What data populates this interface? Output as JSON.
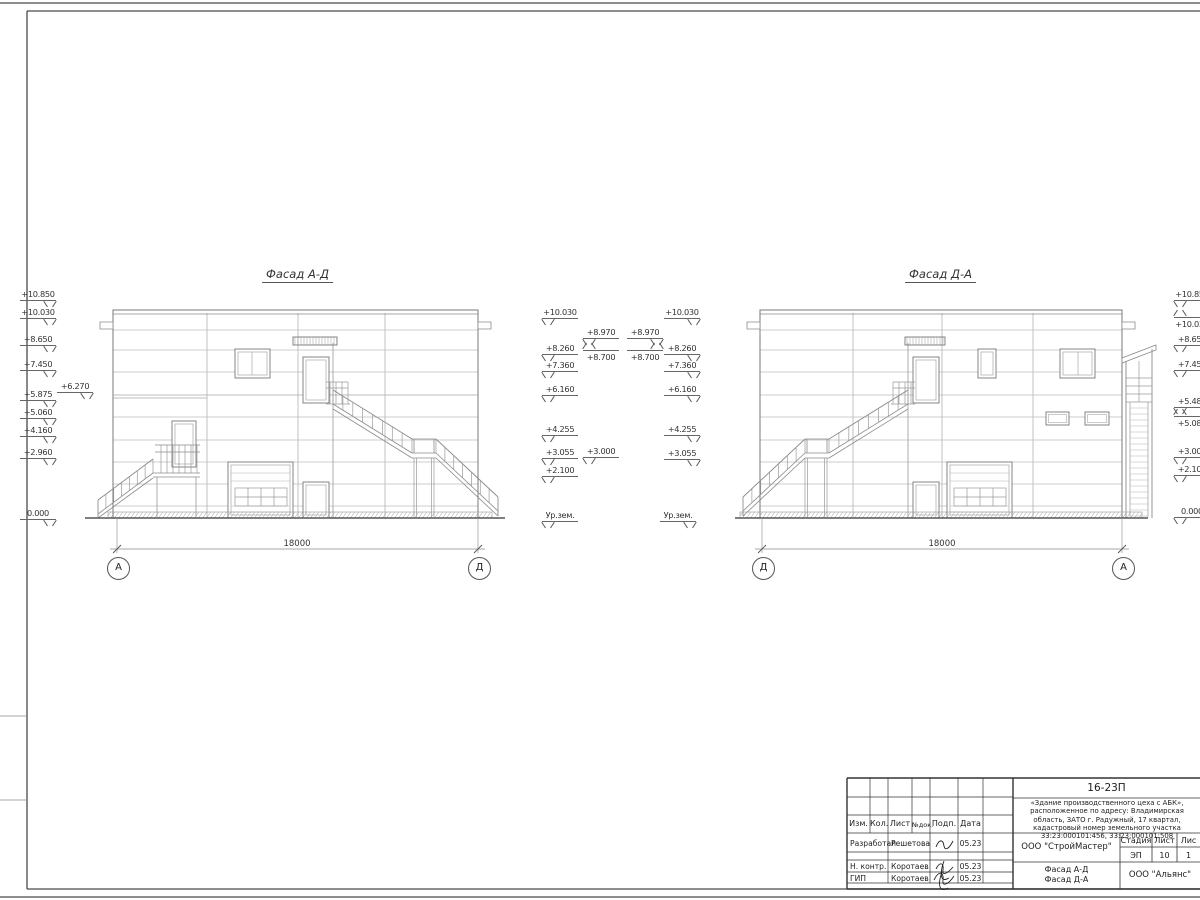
{
  "sheet": {
    "code": "16-23П",
    "project_description": "«Здание производственного цеха с АБК», расположенное по адресу: Владимирская область, ЗАТО г. Радужный, 17 квартал, кадастровый номер земельного участка 33:23:000101:456, 33:23:000101:508",
    "design_org": "ООО \"СтройМастер\"",
    "contractor_org": "ООО \"Альянс\"",
    "sheet_title_line1": "Фасад А-Д",
    "sheet_title_line2": "Фасад Д-А",
    "stage_label": "Стадия",
    "stage_value": "ЭП",
    "sheet_label": "Лист",
    "sheet_value": "10",
    "sheets_label": "Лис",
    "sheets_value": "1",
    "header_cols": [
      "Изм.",
      "Кол.",
      "Лист",
      "№док.",
      "Подп.",
      "Дата"
    ],
    "rows": [
      {
        "role": "Разработал",
        "name": "Решетова",
        "date": "05.23"
      },
      {
        "role": "Н. контр.",
        "name": "Коротаев",
        "date": "05.23"
      },
      {
        "role": "ГИП",
        "name": "Коротаев",
        "date": "05.23"
      }
    ]
  },
  "facades": {
    "left": {
      "title": "Фасад А-Д",
      "dimension": "18000",
      "axis_left": "А",
      "axis_right": "Д"
    },
    "right": {
      "title": "Фасад Д-А",
      "dimension": "18000",
      "axis_left": "Д",
      "axis_right": "А"
    }
  },
  "elevation_marks": [
    {
      "text": "+10.850",
      "x": 20,
      "y": 301,
      "v": "br"
    },
    {
      "text": "+10.030",
      "x": 20,
      "y": 319,
      "v": "br"
    },
    {
      "text": "+8.650",
      "x": 20,
      "y": 346,
      "v": "br"
    },
    {
      "text": "+7.450",
      "x": 20,
      "y": 371,
      "v": "br"
    },
    {
      "text": "+6.270",
      "x": 57,
      "y": 393,
      "v": "br"
    },
    {
      "text": "+5.875",
      "x": 20,
      "y": 401,
      "v": "br"
    },
    {
      "text": "+5.060",
      "x": 20,
      "y": 419,
      "v": "br"
    },
    {
      "text": "+4.160",
      "x": 20,
      "y": 437,
      "v": "br"
    },
    {
      "text": "+2.960",
      "x": 20,
      "y": 459,
      "v": "br"
    },
    {
      "text": "0.000",
      "x": 20,
      "y": 520,
      "v": "br"
    },
    {
      "text": "+10.030",
      "x": 542,
      "y": 319,
      "v": "bl"
    },
    {
      "text": "+8.260",
      "x": 542,
      "y": 355,
      "v": "bl"
    },
    {
      "text": "+7.360",
      "x": 542,
      "y": 372,
      "v": "bl"
    },
    {
      "text": "+6.160",
      "x": 542,
      "y": 396,
      "v": "bl"
    },
    {
      "text": "+4.255",
      "x": 542,
      "y": 436,
      "v": "bl"
    },
    {
      "text": "+3.055",
      "x": 542,
      "y": 459,
      "v": "bl"
    },
    {
      "text": "+2.100",
      "x": 542,
      "y": 477,
      "v": "bl"
    },
    {
      "text": "Ур.зем.",
      "x": 542,
      "y": 522,
      "v": "bl"
    },
    {
      "text": "+8.970",
      "x": 583,
      "y": 339,
      "v": "bl"
    },
    {
      "text": "+8.700",
      "x": 583,
      "y": 350,
      "v": "tl"
    },
    {
      "text": "+8.970",
      "x": 627,
      "y": 339,
      "v": "br"
    },
    {
      "text": "+8.700",
      "x": 627,
      "y": 350,
      "v": "tr"
    },
    {
      "text": "+3.000",
      "x": 583,
      "y": 458,
      "v": "bl"
    },
    {
      "text": "+10.030",
      "x": 664,
      "y": 319,
      "v": "br"
    },
    {
      "text": "+8.260",
      "x": 664,
      "y": 355,
      "v": "br"
    },
    {
      "text": "+7.360",
      "x": 664,
      "y": 372,
      "v": "br"
    },
    {
      "text": "+6.160",
      "x": 664,
      "y": 396,
      "v": "br"
    },
    {
      "text": "+4.255",
      "x": 664,
      "y": 436,
      "v": "br"
    },
    {
      "text": "+3.055",
      "x": 664,
      "y": 460,
      "v": "br"
    },
    {
      "text": "Ур.зем.",
      "x": 660,
      "y": 522,
      "v": "br"
    },
    {
      "text": "+10.850",
      "x": 1174,
      "y": 301,
      "v": "bl"
    },
    {
      "text": "+10.030",
      "x": 1174,
      "y": 317,
      "v": "tl"
    },
    {
      "text": "+8.650",
      "x": 1174,
      "y": 346,
      "v": "bl"
    },
    {
      "text": "+7.450",
      "x": 1174,
      "y": 371,
      "v": "bl"
    },
    {
      "text": "+5.485",
      "x": 1174,
      "y": 408,
      "v": "bl"
    },
    {
      "text": "+5.080",
      "x": 1174,
      "y": 416,
      "v": "tl"
    },
    {
      "text": "+3.000",
      "x": 1174,
      "y": 458,
      "v": "bl"
    },
    {
      "text": "+2.100",
      "x": 1174,
      "y": 476,
      "v": "bl"
    },
    {
      "text": "0.000",
      "x": 1174,
      "y": 518,
      "v": "bl"
    }
  ]
}
